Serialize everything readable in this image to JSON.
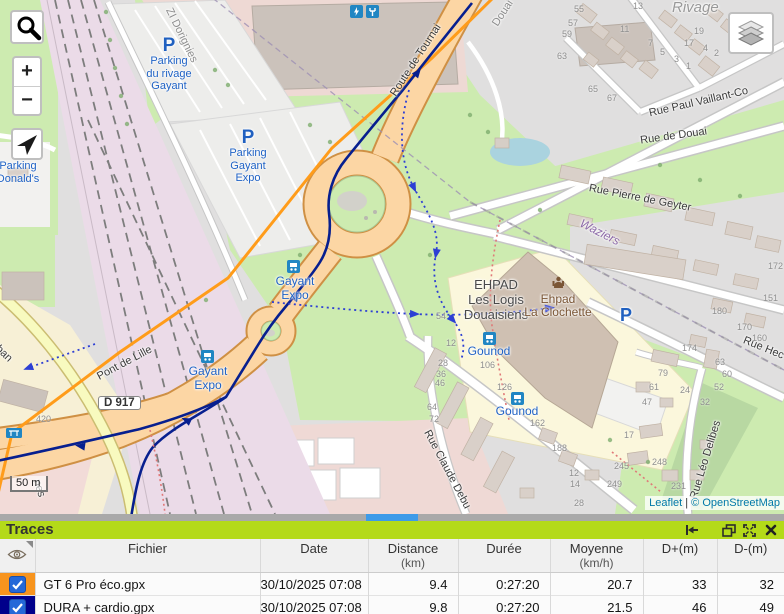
{
  "map": {
    "controls": {
      "zoom_in": "+",
      "zoom_out": "−"
    },
    "scale_label": "50 m",
    "attribution": {
      "leaflet": "Leaflet",
      "separator": " | ",
      "copyright": "© OpenStreetMap"
    },
    "road_badge": "D 917",
    "labels": {
      "zi_dorignies": "ZI Dorignies",
      "parking_icon": "P",
      "parking_rivage_1": "Parking",
      "parking_rivage_2": "du rivage",
      "parking_rivage_3": "Gayant",
      "parking_gayant_1": "Parking",
      "parking_gayant_2": "Gayant",
      "parking_gayant_3": "Expo",
      "route_de_tournai": "Route de Tournai",
      "douai": "Douai",
      "rivage": "Rivage",
      "rue_paul_vaillant": "Rue Paul Vaillant-Co",
      "rue_de_douai": "Rue de Douai",
      "rue_pierre_de_geyter": "Rue Pierre de Geyter",
      "waziers": "Waziers",
      "ehpad_1": "EHPAD",
      "ehpad_2": "Les Logis",
      "ehpad_3": "Douaisiens",
      "clochette_1": "Ehpad",
      "clochette_2": "La Clochette",
      "gounod": "Gounod",
      "rue_claude_debussy": "Rue Claude Debu",
      "rue_leo_delibes": "Rue Léo Delibes",
      "rue_hector": "Rue Hec",
      "pont_de_lille": "Pont de Lille",
      "gayant_expo_1": "Gayant",
      "gayant_expo_2": "Expo",
      "vauban": "Vauban",
      "mcdo_1": "Parking",
      "mcdo_2": "Donald's",
      "rue_fragment": "nes"
    },
    "house_numbers": [
      {
        "t": "55",
        "x": 574,
        "y": 4
      },
      {
        "t": "57",
        "x": 568,
        "y": 18
      },
      {
        "t": "59",
        "x": 562,
        "y": 29
      },
      {
        "t": "63",
        "x": 557,
        "y": 51
      },
      {
        "t": "13",
        "x": 633,
        "y": 1
      },
      {
        "t": "11",
        "x": 620,
        "y": 24
      },
      {
        "t": "7",
        "x": 648,
        "y": 38
      },
      {
        "t": "5",
        "x": 660,
        "y": 47
      },
      {
        "t": "3",
        "x": 674,
        "y": 54
      },
      {
        "t": "1",
        "x": 686,
        "y": 61
      },
      {
        "t": "19",
        "x": 694,
        "y": 26
      },
      {
        "t": "17",
        "x": 684,
        "y": 38
      },
      {
        "t": "4",
        "x": 703,
        "y": 43
      },
      {
        "t": "2",
        "x": 714,
        "y": 48
      },
      {
        "t": "65",
        "x": 588,
        "y": 84
      },
      {
        "t": "67",
        "x": 607,
        "y": 93
      },
      {
        "t": "420",
        "x": 36,
        "y": 414
      },
      {
        "t": "54",
        "x": 436,
        "y": 311
      },
      {
        "t": "12",
        "x": 446,
        "y": 338
      },
      {
        "t": "28",
        "x": 438,
        "y": 358
      },
      {
        "t": "36",
        "x": 436,
        "y": 369
      },
      {
        "t": "46",
        "x": 435,
        "y": 378
      },
      {
        "t": "64",
        "x": 427,
        "y": 402
      },
      {
        "t": "72",
        "x": 429,
        "y": 414
      },
      {
        "t": "106",
        "x": 480,
        "y": 360
      },
      {
        "t": "126",
        "x": 497,
        "y": 382
      },
      {
        "t": "162",
        "x": 530,
        "y": 418
      },
      {
        "t": "188",
        "x": 552,
        "y": 443
      },
      {
        "t": "12",
        "x": 569,
        "y": 468
      },
      {
        "t": "14",
        "x": 570,
        "y": 479
      },
      {
        "t": "28",
        "x": 574,
        "y": 498
      },
      {
        "t": "245",
        "x": 614,
        "y": 461
      },
      {
        "t": "249",
        "x": 607,
        "y": 479
      },
      {
        "t": "17",
        "x": 624,
        "y": 430
      },
      {
        "t": "172",
        "x": 768,
        "y": 261
      },
      {
        "t": "151",
        "x": 763,
        "y": 293
      },
      {
        "t": "180",
        "x": 712,
        "y": 306
      },
      {
        "t": "170",
        "x": 737,
        "y": 322
      },
      {
        "t": "160",
        "x": 752,
        "y": 333
      },
      {
        "t": "174",
        "x": 682,
        "y": 343
      },
      {
        "t": "63",
        "x": 715,
        "y": 357
      },
      {
        "t": "60",
        "x": 722,
        "y": 369
      },
      {
        "t": "52",
        "x": 714,
        "y": 382
      },
      {
        "t": "79",
        "x": 658,
        "y": 368
      },
      {
        "t": "61",
        "x": 649,
        "y": 382
      },
      {
        "t": "47",
        "x": 642,
        "y": 397
      },
      {
        "t": "24",
        "x": 680,
        "y": 385
      },
      {
        "t": "32",
        "x": 700,
        "y": 397
      },
      {
        "t": "248",
        "x": 652,
        "y": 457
      },
      {
        "t": "231",
        "x": 671,
        "y": 481
      }
    ]
  },
  "traces_panel": {
    "title": "Traces",
    "table": {
      "headers": {
        "file": "Fichier",
        "date": "Date",
        "distance": "Distance",
        "distance_unit": "(km)",
        "duration": "Durée",
        "average": "Moyenne",
        "average_unit": "(km/h)",
        "dplus": "D+(m)",
        "dminus": "D-(m)"
      },
      "rows": [
        {
          "checked": true,
          "color": "#f7941e",
          "file": "GT 6 Pro éco.gpx",
          "date": "30/10/2025 07:08",
          "distance": "9.4",
          "duration": "0:27:20",
          "average": "20.7",
          "dplus": "33",
          "dminus": "32"
        },
        {
          "checked": true,
          "color": "#00008b",
          "file": "DURA + cardio.gpx",
          "date": "30/10/2025 07:08",
          "distance": "9.8",
          "duration": "0:27:20",
          "average": "21.5",
          "dplus": "46",
          "dminus": "49"
        }
      ]
    }
  },
  "colors": {
    "panel_header": "#b4da19",
    "trace_1": "#ff9c1a",
    "trace_2": "#071f8f",
    "divider_handle": "#3d9be9"
  }
}
